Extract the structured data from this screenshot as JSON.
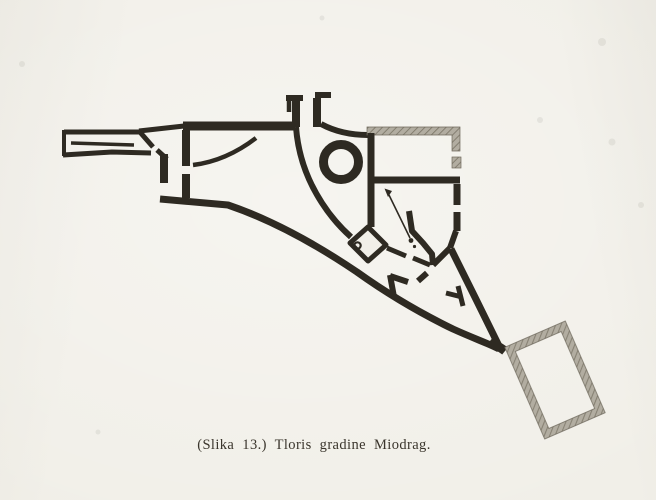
{
  "figure": {
    "caption": "(Slika 13.) Tloris gradine Miodrag.",
    "figure_number": "Slika 13",
    "title": "Tloris gradine Miodrag",
    "colors": {
      "paper": "#f1efe8",
      "ink": "#2e2a22",
      "hatch_fill": "#b2ada1",
      "hatch_line": "#7c7668",
      "hatch_edge": "#6e685c",
      "caption_ink": "#3a352c"
    },
    "plan_features": [
      "west-spur-enclosure",
      "north-curtain-wall",
      "west-door-piers",
      "terrace-arc",
      "main-gate",
      "round-tower",
      "inner-rooms",
      "north-arrow",
      "cistern-room",
      "well",
      "cross-mark",
      "south-rampart",
      "triangular-bailey",
      "southeast-tower"
    ]
  }
}
